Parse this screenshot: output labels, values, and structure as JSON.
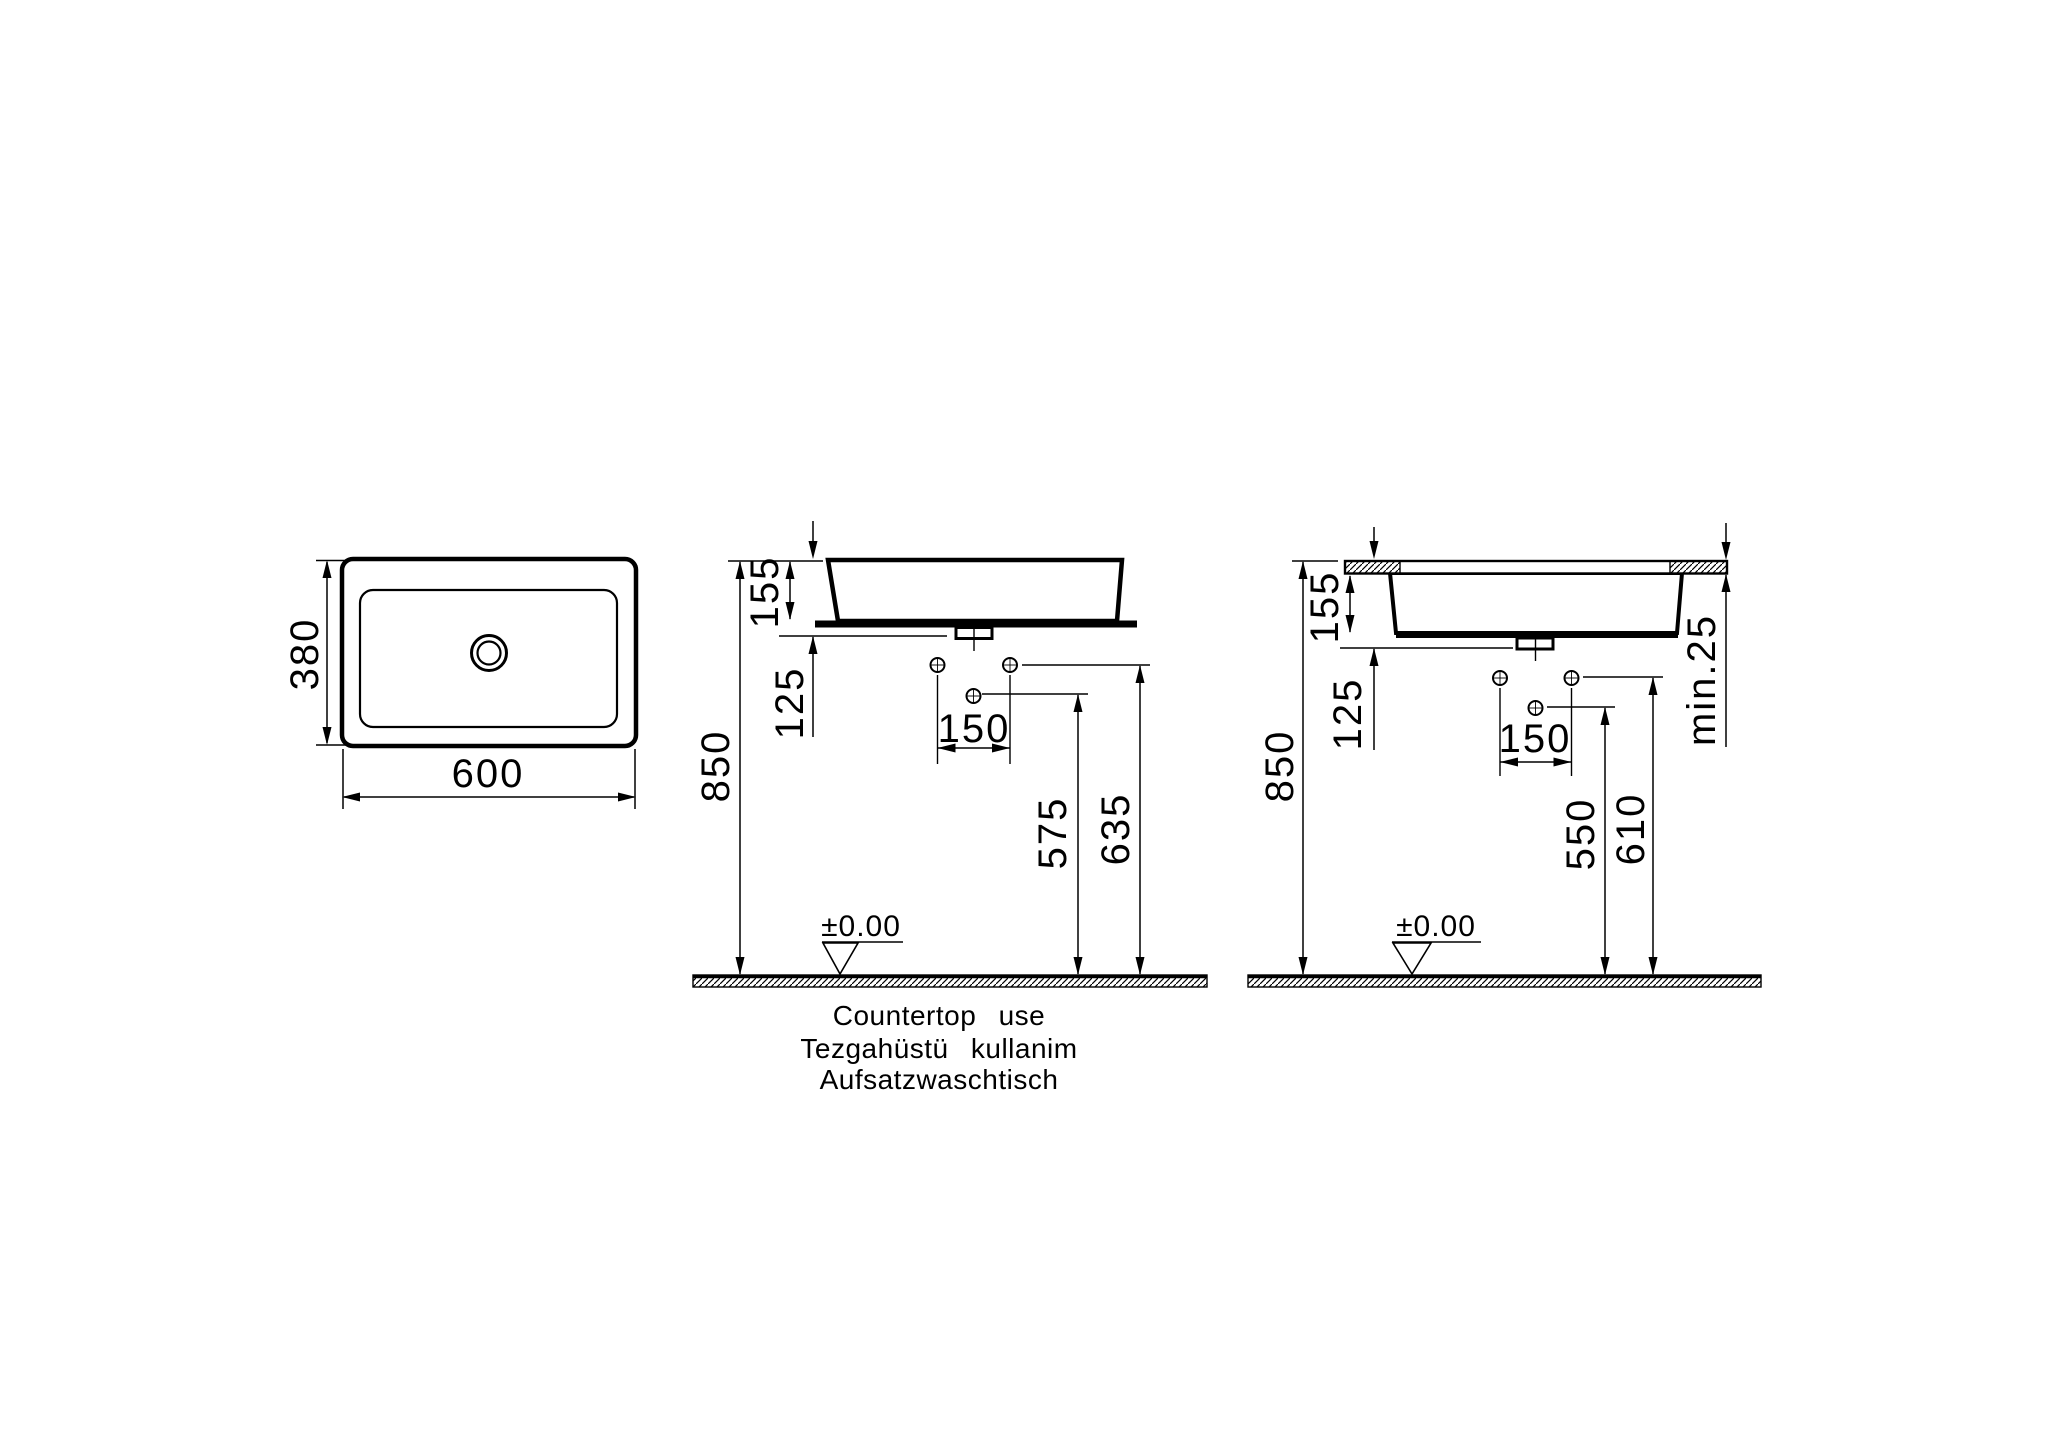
{
  "page": {
    "background_color": "#ffffff",
    "line_color": "#000000",
    "description": "Technical dimension drawing of a rectangular countertop washbasin: plan view and two installation elevations"
  },
  "top_view": {
    "width": "600",
    "depth": "380"
  },
  "countertop_view": {
    "basin_height": "155",
    "hole_drop": "125",
    "hole_spacing": "150",
    "counter_height": "850",
    "lower_hole_height": "575",
    "upper_hole_height": "635",
    "datum": "±0.00"
  },
  "recessed_view": {
    "basin_height": "155",
    "hole_drop": "125",
    "hole_spacing": "150",
    "counter_height": "850",
    "lower_hole_height": "550",
    "upper_hole_height": "610",
    "min_counter_thickness": "min.25",
    "datum": "±0.00"
  },
  "caption": {
    "line1_en": "Countertop  use",
    "line2_tr": "Tezgahüstü  kullanim",
    "line3_de": "Aufsatzwaschtisch"
  },
  "icons": {
    "datum_symbol": "triangle-down-datum",
    "floor_fill": "diagonal-hatch",
    "counter_cut_fill": "diagonal-hatch"
  }
}
